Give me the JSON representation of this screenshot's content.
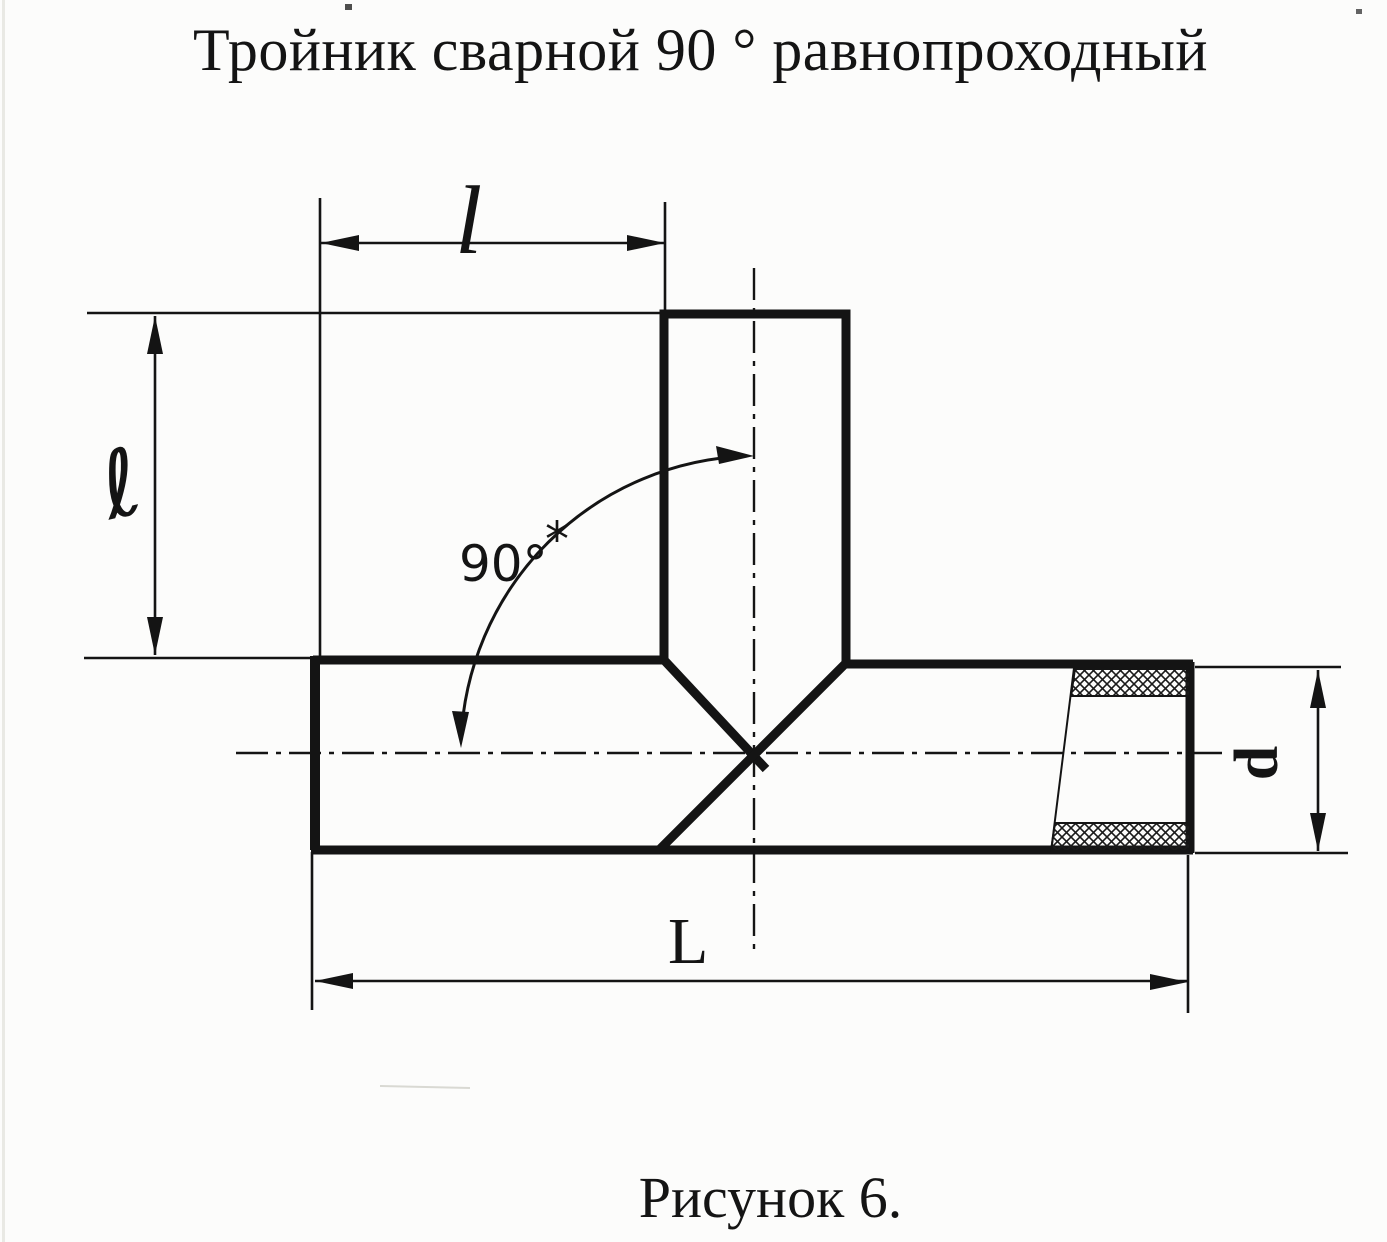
{
  "title": "Тройник сварной 90 ° равнопроходный",
  "caption": "Рисунок 6.",
  "drawing": {
    "subject": "welded 90-degree equal-bore tee, dimensioned section view",
    "labels": {
      "top_length": "l",
      "left_height": "ℓ",
      "angle": "90°",
      "angle_note": "*",
      "overall_length": "L",
      "diameter": "d"
    },
    "ink": "#141414",
    "paper": "#fcfcfb"
  }
}
